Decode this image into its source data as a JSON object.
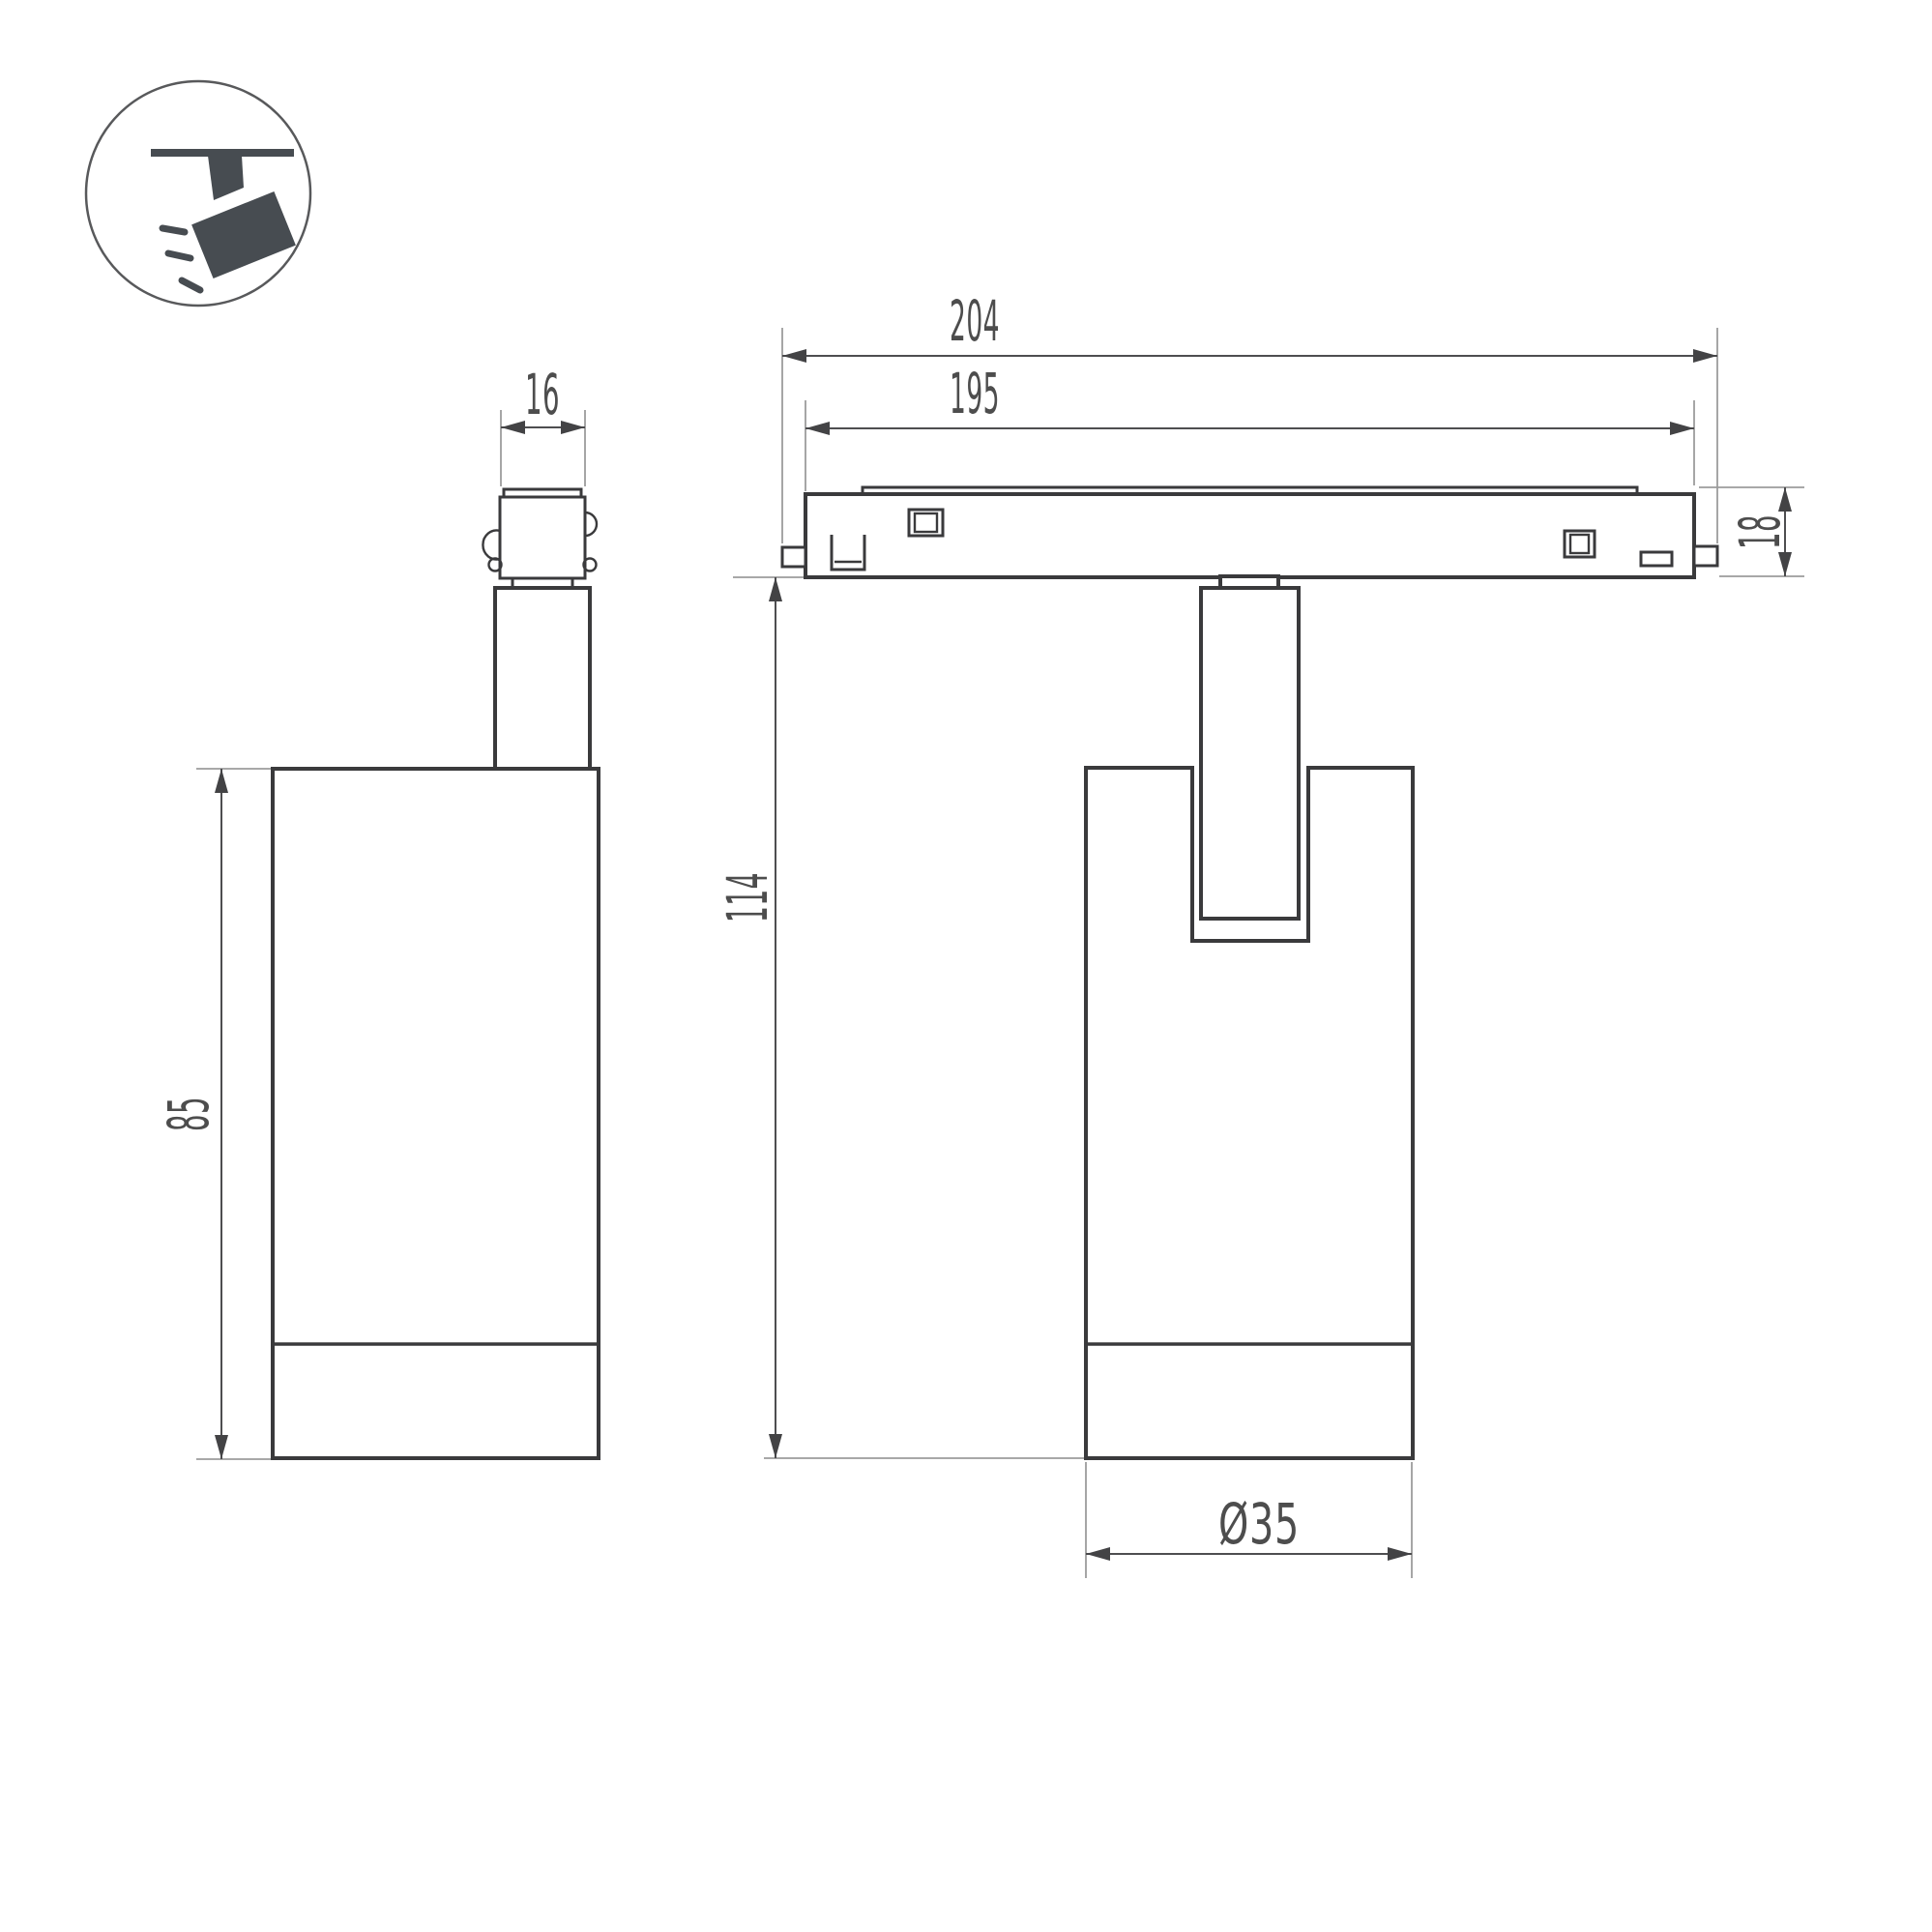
{
  "page": {
    "background": "#ffffff",
    "type": "technical-dimension-drawing",
    "subject": "magnetic-track-spotlight"
  },
  "colors": {
    "object_outline": "#3a3a3c",
    "dimension_line": "#4e4e50",
    "extension_line": "#9c9c9c",
    "dimension_text": "#4d4d4d",
    "icon": "#474c51",
    "icon_ring": "#58595b"
  },
  "icon": {
    "name": "spotlight-on-track-icon"
  },
  "dimensions": {
    "track_length_outer": "204",
    "track_length_body": "195",
    "track_height": "18",
    "adapter_width": "16",
    "body_height": "85",
    "overall_height": "114",
    "body_diameter": "Ø35"
  }
}
